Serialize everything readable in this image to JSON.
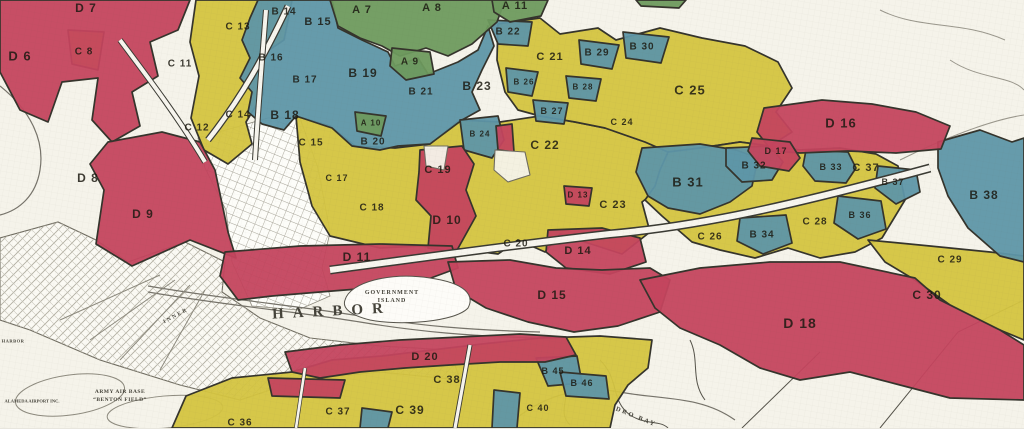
{
  "map": {
    "colors": {
      "paper": "#f5f3ea",
      "grade_a_green": "#6e9a5e",
      "grade_b_blue": "#5e96a8",
      "grade_c_yellow": "#d4c440",
      "grade_d_red": "#c4455e",
      "boundary_ink": "#35342c"
    },
    "regions": [
      {
        "id": "A7",
        "label": "A 7",
        "grade": "A",
        "x": 362,
        "y": 10,
        "size": 11
      },
      {
        "id": "A8",
        "label": "A 8",
        "grade": "A",
        "x": 432,
        "y": 8,
        "size": 11
      },
      {
        "id": "A9",
        "label": "A 9",
        "grade": "A",
        "x": 410,
        "y": 62
      },
      {
        "id": "A10",
        "label": "A 10",
        "grade": "A",
        "x": 371,
        "y": 123,
        "size": 8
      },
      {
        "id": "A11",
        "label": "A 11",
        "grade": "A",
        "x": 515,
        "y": 6,
        "size": 11
      },
      {
        "id": "B14",
        "label": "B 14",
        "grade": "B",
        "x": 284,
        "y": 12
      },
      {
        "id": "B15",
        "label": "B 15",
        "grade": "B",
        "x": 318,
        "y": 22,
        "size": 11
      },
      {
        "id": "B16",
        "label": "B 16",
        "grade": "B",
        "x": 271,
        "y": 58
      },
      {
        "id": "B17",
        "label": "B 17",
        "grade": "B",
        "x": 305,
        "y": 80
      },
      {
        "id": "B18",
        "label": "B 18",
        "grade": "B",
        "x": 285,
        "y": 115,
        "size": 12
      },
      {
        "id": "B19",
        "label": "B 19",
        "grade": "B",
        "x": 363,
        "y": 73,
        "size": 12
      },
      {
        "id": "B20",
        "label": "B 20",
        "grade": "B",
        "x": 373,
        "y": 142
      },
      {
        "id": "B21",
        "label": "B 21",
        "grade": "B",
        "x": 421,
        "y": 92
      },
      {
        "id": "B22",
        "label": "B 22",
        "grade": "B",
        "x": 508,
        "y": 32
      },
      {
        "id": "B23",
        "label": "B 23",
        "grade": "B",
        "x": 477,
        "y": 86,
        "size": 12
      },
      {
        "id": "B24",
        "label": "B 24",
        "grade": "B",
        "x": 480,
        "y": 134,
        "size": 8
      },
      {
        "id": "B26",
        "label": "B 26",
        "grade": "B",
        "x": 524,
        "y": 82,
        "size": 8
      },
      {
        "id": "B27",
        "label": "B 27",
        "grade": "B",
        "x": 552,
        "y": 111,
        "size": 9
      },
      {
        "id": "B28",
        "label": "B 28",
        "grade": "B",
        "x": 583,
        "y": 87,
        "size": 8
      },
      {
        "id": "B29",
        "label": "B 29",
        "grade": "B",
        "x": 597,
        "y": 53
      },
      {
        "id": "B30",
        "label": "B 30",
        "grade": "B",
        "x": 642,
        "y": 47
      },
      {
        "id": "B31",
        "label": "B 31",
        "grade": "B",
        "x": 688,
        "y": 182,
        "size": 13
      },
      {
        "id": "B32",
        "label": "B 32",
        "grade": "B",
        "x": 754,
        "y": 166
      },
      {
        "id": "B33",
        "label": "B 33",
        "grade": "B",
        "x": 831,
        "y": 167,
        "size": 9
      },
      {
        "id": "B34",
        "label": "B 34",
        "grade": "B",
        "x": 762,
        "y": 235
      },
      {
        "id": "B36",
        "label": "B 36",
        "grade": "B",
        "x": 860,
        "y": 215,
        "size": 9
      },
      {
        "id": "B37",
        "label": "B 37",
        "grade": "B",
        "x": 893,
        "y": 182,
        "size": 9
      },
      {
        "id": "B38",
        "label": "B 38",
        "grade": "B",
        "x": 984,
        "y": 195,
        "size": 12
      },
      {
        "id": "B45",
        "label": "B 45",
        "grade": "B",
        "x": 553,
        "y": 371,
        "size": 9
      },
      {
        "id": "B46",
        "label": "B 46",
        "grade": "B",
        "x": 582,
        "y": 383,
        "size": 9
      },
      {
        "id": "C8",
        "label": "C 8",
        "grade": "C",
        "x": 84,
        "y": 52
      },
      {
        "id": "C11",
        "label": "C 11",
        "grade": "C",
        "x": 180,
        "y": 64
      },
      {
        "id": "C12",
        "label": "C 12",
        "grade": "C",
        "x": 197,
        "y": 128
      },
      {
        "id": "C13",
        "label": "C 13",
        "grade": "C",
        "x": 238,
        "y": 27
      },
      {
        "id": "C14",
        "label": "C 14",
        "grade": "C",
        "x": 238,
        "y": 115
      },
      {
        "id": "C15",
        "label": "C 15",
        "grade": "C",
        "x": 311,
        "y": 143
      },
      {
        "id": "C17",
        "label": "C 17",
        "grade": "C",
        "x": 337,
        "y": 178,
        "size": 9
      },
      {
        "id": "C18",
        "label": "C 18",
        "grade": "C",
        "x": 372,
        "y": 208
      },
      {
        "id": "C19",
        "label": "C 19",
        "grade": "C",
        "x": 438,
        "y": 170,
        "size": 11
      },
      {
        "id": "C20",
        "label": "C 20",
        "grade": "C",
        "x": 516,
        "y": 244
      },
      {
        "id": "C21",
        "label": "C 21",
        "grade": "C",
        "x": 550,
        "y": 57,
        "size": 11
      },
      {
        "id": "C22",
        "label": "C 22",
        "grade": "C",
        "x": 545,
        "y": 145,
        "size": 12
      },
      {
        "id": "C23",
        "label": "C 23",
        "grade": "C",
        "x": 613,
        "y": 205,
        "size": 11
      },
      {
        "id": "C24",
        "label": "C 24",
        "grade": "C",
        "x": 622,
        "y": 122,
        "size": 9
      },
      {
        "id": "C25",
        "label": "C 25",
        "grade": "C",
        "x": 690,
        "y": 90,
        "size": 13
      },
      {
        "id": "C26",
        "label": "C 26",
        "grade": "C",
        "x": 710,
        "y": 237
      },
      {
        "id": "C28",
        "label": "C 28",
        "grade": "C",
        "x": 815,
        "y": 222
      },
      {
        "id": "C29",
        "label": "C 29",
        "grade": "C",
        "x": 950,
        "y": 260
      },
      {
        "id": "C30",
        "label": "C 30",
        "grade": "C",
        "x": 927,
        "y": 295,
        "size": 12
      },
      {
        "id": "C36",
        "label": "C 36",
        "grade": "C",
        "x": 240,
        "y": 423
      },
      {
        "id": "C37",
        "label": "C 37",
        "grade": "C",
        "x": 866,
        "y": 168,
        "size": 11
      },
      {
        "id": "C37b",
        "label": "C 37",
        "grade": "C",
        "x": 338,
        "y": 412
      },
      {
        "id": "C38",
        "label": "C 38",
        "grade": "C",
        "x": 447,
        "y": 380,
        "size": 11
      },
      {
        "id": "C39",
        "label": "C 39",
        "grade": "C",
        "x": 410,
        "y": 410,
        "size": 12
      },
      {
        "id": "C40",
        "label": "C 40",
        "grade": "C",
        "x": 538,
        "y": 408,
        "size": 9
      },
      {
        "id": "D6",
        "label": "D 6",
        "grade": "D",
        "x": 20,
        "y": 56,
        "size": 13
      },
      {
        "id": "D7",
        "label": "D 7",
        "grade": "D",
        "x": 86,
        "y": 8,
        "size": 12
      },
      {
        "id": "D8",
        "label": "D 8",
        "grade": "D",
        "x": 88,
        "y": 178,
        "size": 12
      },
      {
        "id": "D9",
        "label": "D 9",
        "grade": "D",
        "x": 143,
        "y": 214,
        "size": 12
      },
      {
        "id": "D10",
        "label": "D 10",
        "grade": "D",
        "x": 447,
        "y": 220,
        "size": 12
      },
      {
        "id": "D11",
        "label": "D 11",
        "grade": "D",
        "x": 357,
        "y": 257,
        "size": 12
      },
      {
        "id": "D13",
        "label": "D 13",
        "grade": "D",
        "x": 578,
        "y": 195,
        "size": 8
      },
      {
        "id": "D14",
        "label": "D 14",
        "grade": "D",
        "x": 578,
        "y": 251,
        "size": 11
      },
      {
        "id": "D15",
        "label": "D 15",
        "grade": "D",
        "x": 552,
        "y": 295,
        "size": 12
      },
      {
        "id": "D16",
        "label": "D 16",
        "grade": "D",
        "x": 841,
        "y": 123,
        "size": 13
      },
      {
        "id": "D17",
        "label": "D 17",
        "grade": "D",
        "x": 776,
        "y": 151,
        "size": 9
      },
      {
        "id": "D18",
        "label": "D 18",
        "grade": "D",
        "x": 800,
        "y": 323,
        "size": 14
      },
      {
        "id": "D20",
        "label": "D 20",
        "grade": "D",
        "x": 425,
        "y": 357,
        "size": 11
      }
    ],
    "geo_labels": [
      {
        "id": "harbor-main",
        "text": "HARBOR",
        "x": 332,
        "y": 312,
        "size": 15,
        "spacing": 9,
        "rotate": -3
      },
      {
        "id": "government-island-1",
        "text": "GOVERNMENT",
        "x": 392,
        "y": 293,
        "size": 6,
        "spacing": 1
      },
      {
        "id": "government-island-2",
        "text": "ISLAND",
        "x": 392,
        "y": 301,
        "size": 6,
        "spacing": 1
      },
      {
        "id": "army-air-base-1",
        "text": "ARMY AIR BASE",
        "x": 120,
        "y": 392,
        "size": 5.5,
        "spacing": 0.5
      },
      {
        "id": "army-air-base-2",
        "text": "“BENTON FIELD”",
        "x": 120,
        "y": 400,
        "size": 5.5,
        "spacing": 0.5
      },
      {
        "id": "alameda-airport",
        "text": "ALAMEDA AIRPORT INC.",
        "x": 32,
        "y": 401,
        "size": 4.5,
        "spacing": 0
      },
      {
        "id": "harbor-left-edge",
        "text": "HARBOR",
        "x": 13,
        "y": 341,
        "size": 4.5,
        "spacing": 0.5
      },
      {
        "id": "leandro-bay",
        "text": "DRO BAY",
        "x": 636,
        "y": 417,
        "size": 6.5,
        "spacing": 2,
        "rotate": 22
      },
      {
        "id": "inner-channel",
        "text": "INNER",
        "x": 176,
        "y": 316,
        "size": 5.5,
        "spacing": 2,
        "rotate": -28
      }
    ]
  }
}
